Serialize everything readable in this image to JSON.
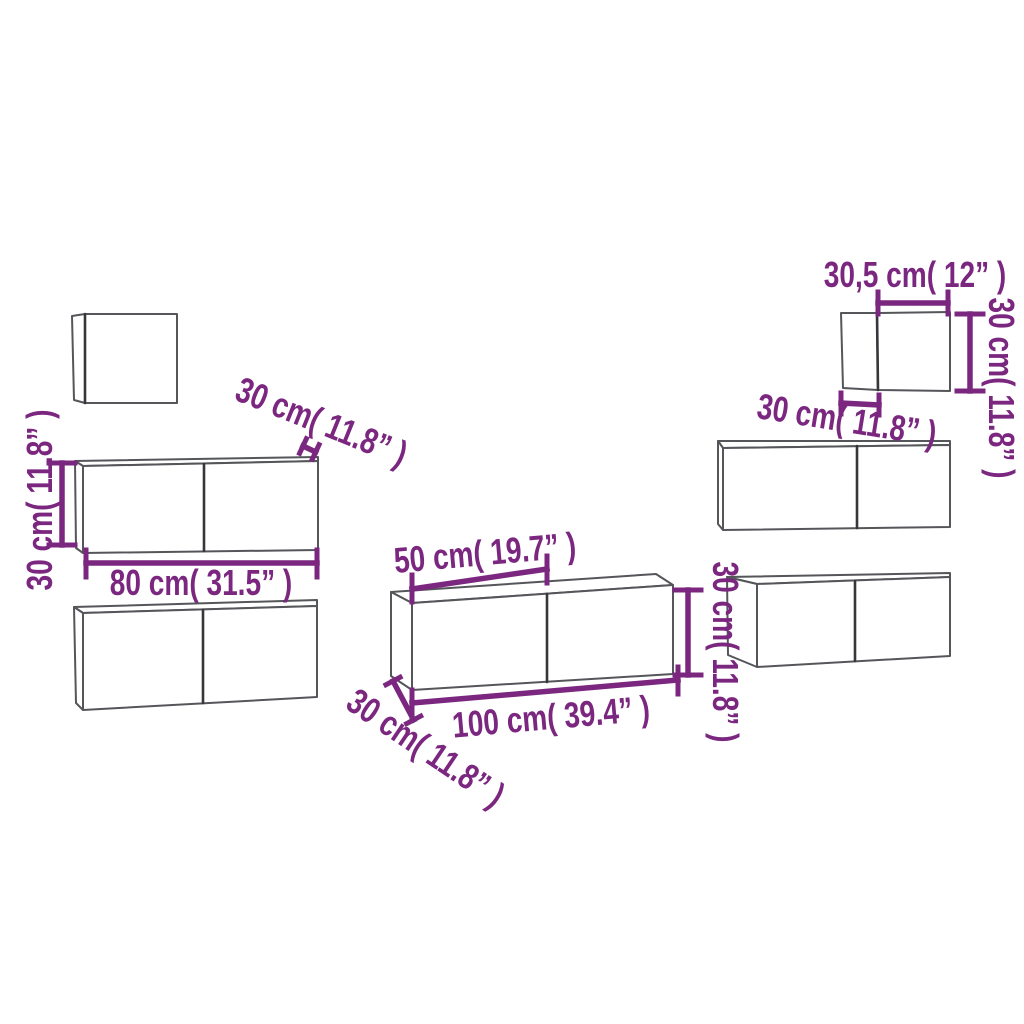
{
  "diagram": {
    "background": "#ffffff",
    "dimension_color": "#7b2780",
    "outline_color": "#55565a",
    "divider_color": "#37373b",
    "labels": {
      "left_cabinet_height": "30 cm( 11.8” )",
      "left_cabinet_width": "80 cm( 31.5” )",
      "left_cabinet_depth": "30 cm( 11.8” )",
      "long_cabinet_door_width": "50 cm( 19.7” )",
      "long_cabinet_width": "100 cm( 39.4” )",
      "long_cabinet_height": "30 cm( 11.8” )",
      "long_cabinet_depth": "30 cm( 11.8” )",
      "small_cabinet_width": "30,5 cm( 12” )",
      "small_cabinet_height": "30 cm( 11.8” )",
      "small_cabinet_depth": "30 cm( 11.8” )"
    }
  }
}
